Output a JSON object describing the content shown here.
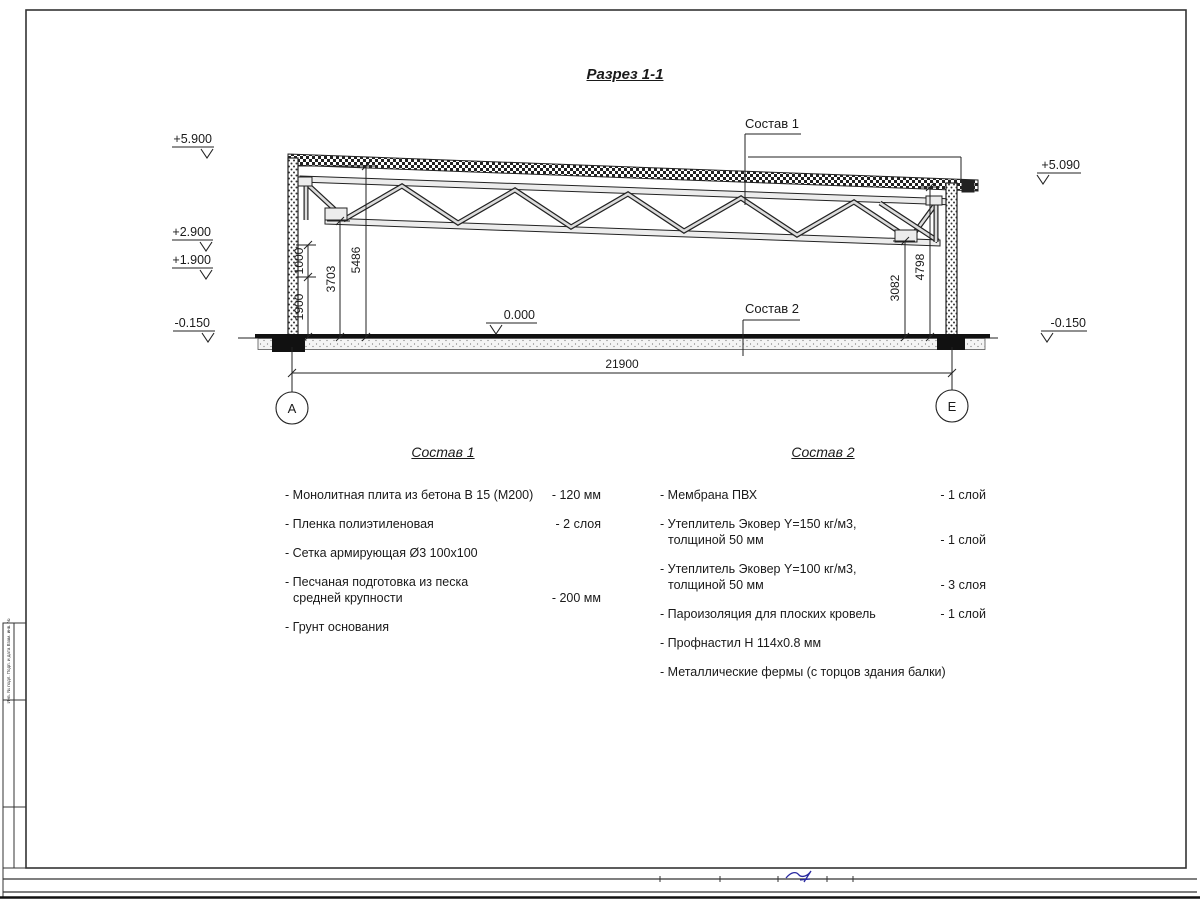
{
  "drawing": {
    "title": "Разрез 1-1",
    "composition1_label": "Состав 1",
    "composition2_label": "Состав 2",
    "elevations": {
      "e5900": "+5.900",
      "e2900": "+2.900",
      "e1900": "+1.900",
      "eneg150_left": "-0.150",
      "e0": "0.000",
      "e5090": "+5.090",
      "eneg150_right": "-0.150"
    },
    "dims": {
      "d1000": "1000",
      "d1900": "1900",
      "d3703": "3703",
      "d5486": "5486",
      "d3082": "3082",
      "d4798": "4798",
      "d21900": "21900"
    },
    "axes": {
      "left": "А",
      "right": "Е"
    }
  },
  "composition1": {
    "title": "Состав 1",
    "items": [
      {
        "line1": "- Монолитная плита из бетона В 15 (М200)",
        "line2": "",
        "value": "- 120 мм"
      },
      {
        "line1": "- Пленка полиэтиленовая",
        "line2": "",
        "value": "- 2 слоя"
      },
      {
        "line1": "- Сетка армирующая Ø3 100х100",
        "line2": "",
        "value": ""
      },
      {
        "line1": "- Песчаная подготовка из песка",
        "line2": "средней крупности",
        "value": "- 200 мм"
      },
      {
        "line1": "- Грунт основания",
        "line2": "",
        "value": ""
      }
    ]
  },
  "composition2": {
    "title": "Состав 2",
    "items": [
      {
        "line1": "- Мембрана ПВХ",
        "line2": "",
        "value": "- 1 слой"
      },
      {
        "line1": "- Утеплитель Эковер Y=150 кг/м3,",
        "line2": "толщиной 50 мм",
        "value": "- 1 слой"
      },
      {
        "line1": "- Утеплитель Эковер Y=100 кг/м3,",
        "line2": "толщиной 50 мм",
        "value": "- 3 слоя"
      },
      {
        "line1": "- Пароизоляция для плоских кровель",
        "line2": "",
        "value": "- 1 слой"
      },
      {
        "line1": "- Профнастил Н 114х0.8 мм",
        "line2": "",
        "value": ""
      },
      {
        "line1": "- Металлические фермы (с торцов здания балки)",
        "line2": "",
        "value": ""
      }
    ]
  },
  "frame": {
    "stamp_text": "Инв. № подл.  Подп. и дата  Взам. инв. №"
  }
}
